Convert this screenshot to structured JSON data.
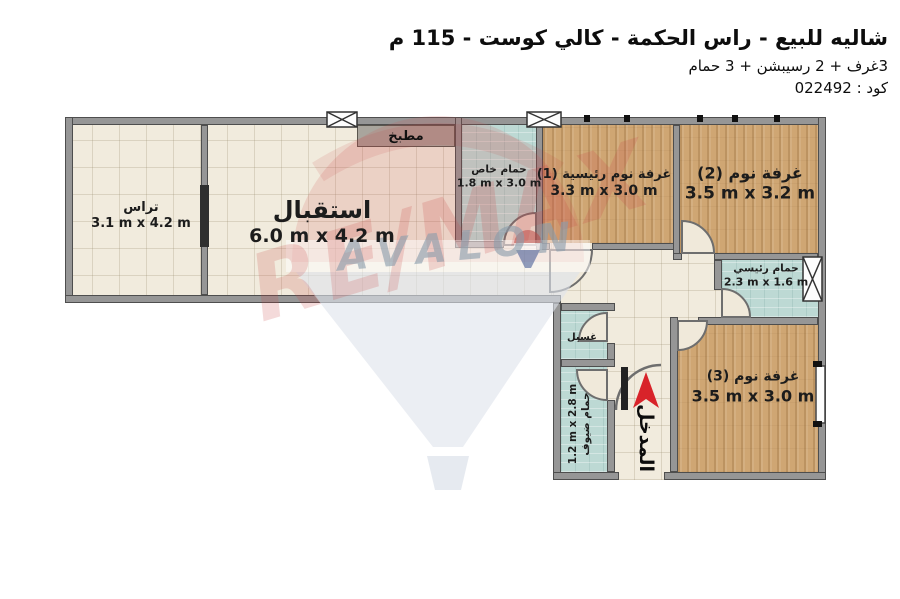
{
  "header": {
    "title": "شاليه للبيع - راس الحكمة - كالي كوست - 115 م",
    "subtitle": "3غرف + 2 رسيبشن + 3 حمام",
    "code_line": "كود : 022492"
  },
  "rooms": {
    "terrace": {
      "name": "تراس",
      "dims": "3.1 m x 4.2 m"
    },
    "reception": {
      "name": "استقبال",
      "dims": "6.0 m x 4.2 m"
    },
    "kitchen": {
      "name": "مطبخ"
    },
    "private_bath": {
      "name": "حمام خاص",
      "dims": "1.8 m x 3.0 m"
    },
    "master_bedroom": {
      "name": "غرفة نوم رئيسية (1)",
      "dims": "3.3 m x 3.0 m"
    },
    "bedroom2": {
      "name": "غرفة نوم (2)",
      "dims": "3.5 m x 3.2 m"
    },
    "master_bath": {
      "name": "حمام رئيسي",
      "dims": "2.3 m x 1.6 m"
    },
    "bedroom3": {
      "name": "غرفة نوم (3)",
      "dims": "3.5 m x 3.0 m"
    },
    "laundry": {
      "name": "غسيل"
    },
    "guest_bath": {
      "name": "حمام ضيوف",
      "dims": "1.2 m x 2.8 m"
    }
  },
  "entrance": {
    "label": "المدخل"
  },
  "watermark": {
    "brand": "RE/MAX",
    "agency": "AVALON"
  },
  "colors": {
    "entrance_arrow": "#d8232a",
    "wall": "#969696",
    "tile_floor": "#f1ebdd",
    "wood_floor": "#cfa673",
    "bath_floor": "#bdd9d4",
    "watermark_red": "#c94444",
    "watermark_gray": "#8b9dab"
  }
}
